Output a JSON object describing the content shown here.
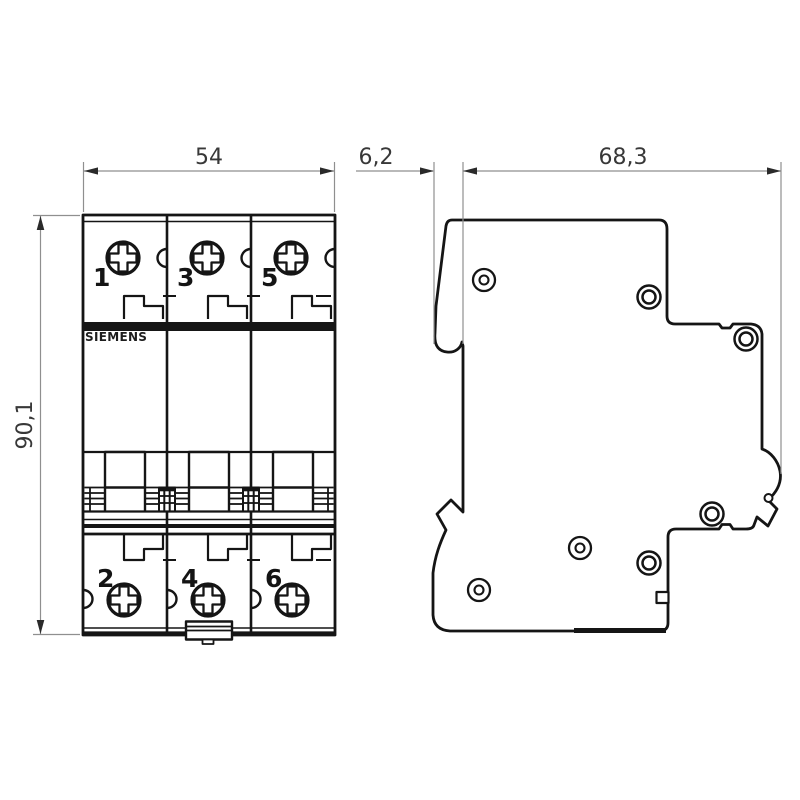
{
  "drawing": {
    "brand_label": "SIEMENS",
    "front_view": {
      "width_label": "54",
      "height_label": "90,1",
      "pole_labels_top": [
        "1",
        "3",
        "5"
      ],
      "pole_labels_bottom": [
        "2",
        "4",
        "6"
      ]
    },
    "side_view": {
      "clip_depth_label": "6,2",
      "body_depth_label": "68,3"
    },
    "icons": {
      "screw": "phillips-screw-icon",
      "rivet": "rivet-icon"
    },
    "colors": {
      "outline": "#151515",
      "dimension_line": "#8f8f8f",
      "text": "#383838",
      "background": "#ffffff"
    }
  }
}
